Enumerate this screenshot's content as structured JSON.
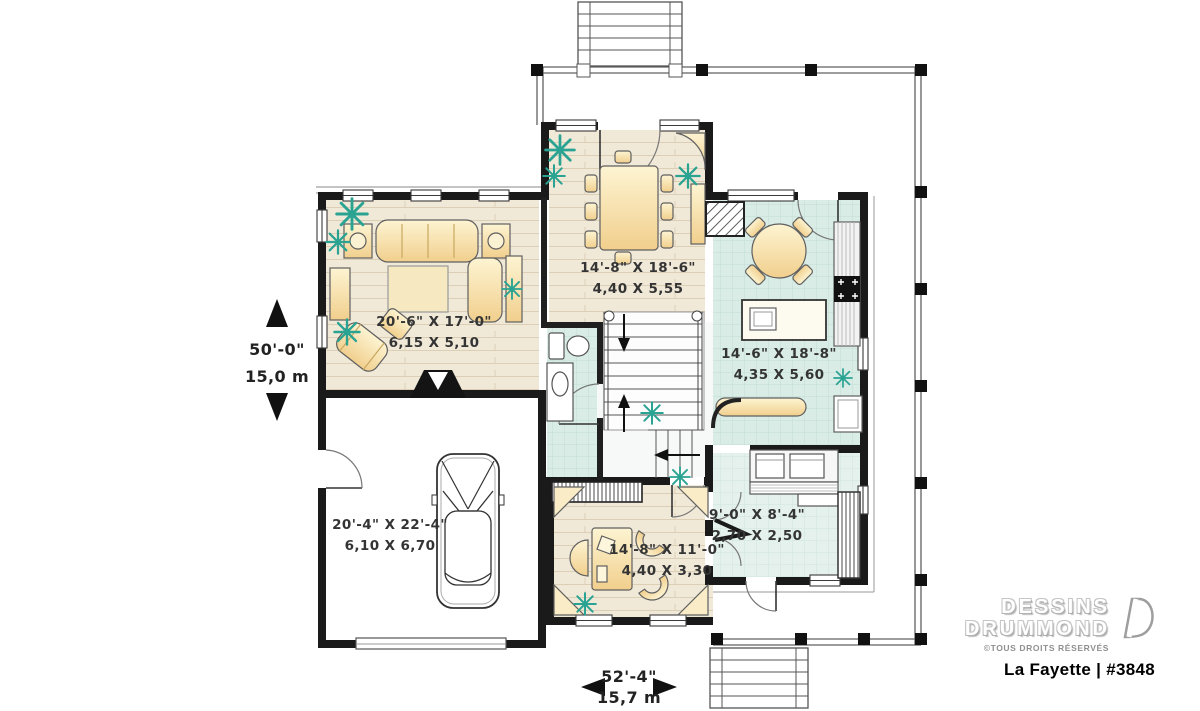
{
  "plan": {
    "title": "La Fayette | #3848",
    "brand": {
      "name_line1": "DESSINS",
      "name_line2": "DRUMMOND",
      "copyright": "©TOUS DROITS RÉSERVÉS"
    },
    "overall_dims": {
      "width_imperial": "50'-0\"",
      "width_metric": "15,0 m",
      "depth_imperial": "52'-4\"",
      "depth_metric": "15,7 m"
    },
    "rooms": [
      {
        "name": "living-room",
        "imperial": "20'-6\" X 17'-0\"",
        "metric": "6,15 X 5,10"
      },
      {
        "name": "dining-room",
        "imperial": "14'-8\" X 18'-6\"",
        "metric": "4,40 X 5,55"
      },
      {
        "name": "kitchen",
        "imperial": "14'-6\" X 18'-8\"",
        "metric": "4,35 X 5,60"
      },
      {
        "name": "garage",
        "imperial": "20'-4\" X 22'-4\"",
        "metric": "6,10 X 6,70"
      },
      {
        "name": "office",
        "imperial": "14'-8\" X 11'-0\"",
        "metric": "4,40 X 3,30"
      },
      {
        "name": "mudroom",
        "imperial": "9'-0\" X 8'-4\"",
        "metric": "2,70 X 2,50"
      }
    ],
    "icons": {
      "plant_symbol": "✳",
      "dimension_arrow_up": "▲",
      "dimension_arrow_down": "▼",
      "dimension_arrow_left": "◀",
      "dimension_arrow_right": "▶"
    },
    "colors": {
      "wall": "#1a1a1a",
      "wood_floor": "#f1e9d8",
      "tile_floor": "#d9ece6",
      "furniture": "#f5dfa4",
      "plant": "#2aa392",
      "logo_gray": "#b5b5b5",
      "title_black": "#000000"
    }
  }
}
